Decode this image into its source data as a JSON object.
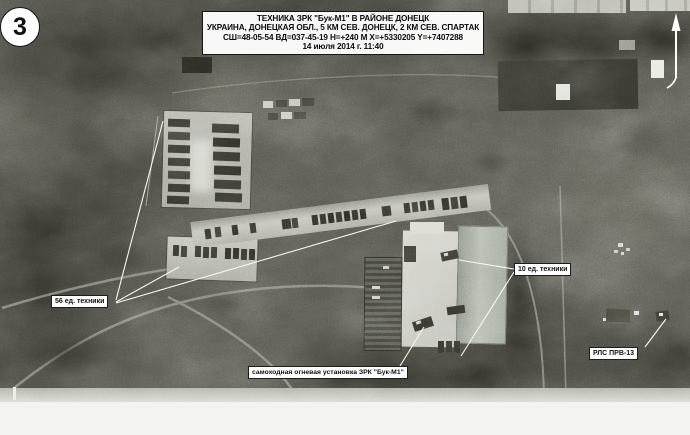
{
  "slide": {
    "badge_number": "3",
    "header": {
      "line1": "ТЕХНИКА ЗРК \"Бук-М1\"  В РАЙОНЕ ДОНЕЦК",
      "line2": "УКРАИНА, ДОНЕЦКАЯ ОБЛ., 5 КМ СЕВ. ДОНЕЦК, 2 КМ СЕВ. СПАРТАК",
      "line3": "СШ=48-05-54 ВД=037-45-19 Н=+240 М Х=+5330205 Y=+7407288",
      "line4": "14 июля 2014 г. 11:40"
    },
    "callouts": {
      "vehicles56": "56 ед. техники",
      "vehicles10": "10 ед. техники",
      "buk": "самоходная огневая установка ЗРК \"Бук-М1\"",
      "radar": "РЛС ПРВ-13"
    },
    "colors": {
      "photo_base": "#52524b",
      "label_background": "#ffffff",
      "label_border": "#1c1c1c",
      "annotation_lines": "#f7f7f4"
    }
  }
}
